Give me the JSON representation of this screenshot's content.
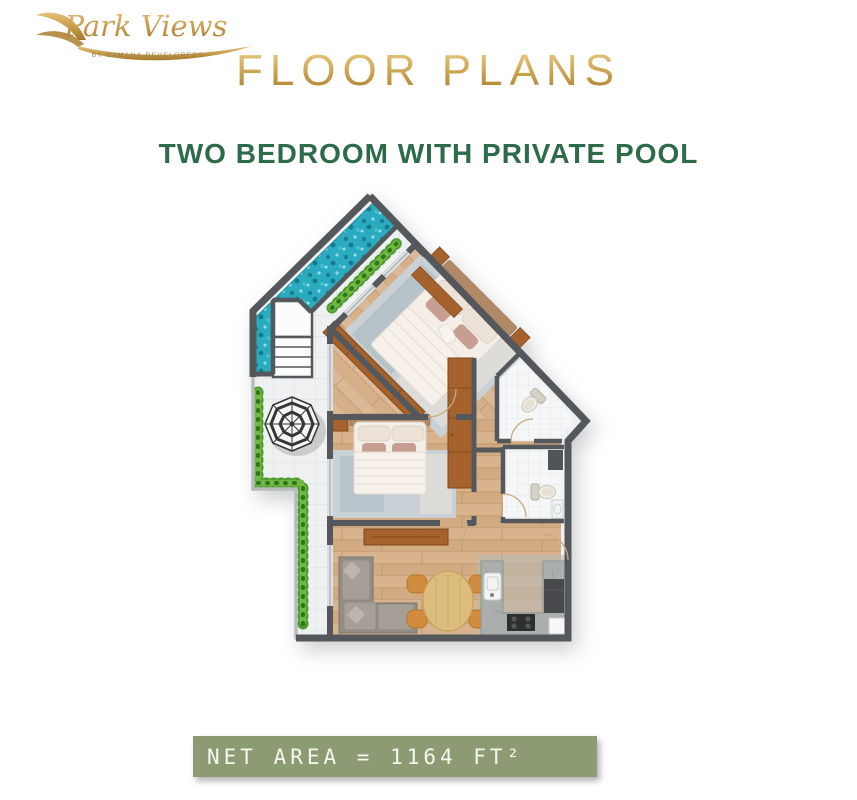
{
  "logo": {
    "brand": "Park Views",
    "tagline": "BY SAMANA DEVELOPERS"
  },
  "header": {
    "title": "FLOOR PLANS",
    "subtitle": "TWO BEDROOM WITH PRIVATE POOL"
  },
  "footer": {
    "net_area": "NET AREA = 1164 FT²"
  },
  "colors": {
    "title_gold_light": "#e8cc83",
    "title_gold_dark": "#a87c2c",
    "subtitle_green": "#2d6b49",
    "footer_bar": "#8d9b74",
    "footer_text": "#f5f7ef",
    "pool_water": "#2babbf",
    "hedge_green": "#4f9a2e",
    "wood_floor": "#d8b38d",
    "wall_gray": "#54575b",
    "terrace_tile": "#eef0f1",
    "wardrobe_brown": "#a5622c"
  },
  "floor_plan": {
    "alt": "two-bedroom-with-private-pool-floor-plan",
    "elements": [
      "private-pool",
      "pool-stairs",
      "hedge",
      "patio-umbrella",
      "master-bed",
      "second-bed",
      "wardrobe",
      "sofa",
      "tv-console",
      "dining-table",
      "dining-chairs",
      "kitchen-counter",
      "sink",
      "stove",
      "fridge",
      "ensuite-toilet",
      "guest-toilet",
      "bath-cabinet",
      "vanity"
    ]
  }
}
